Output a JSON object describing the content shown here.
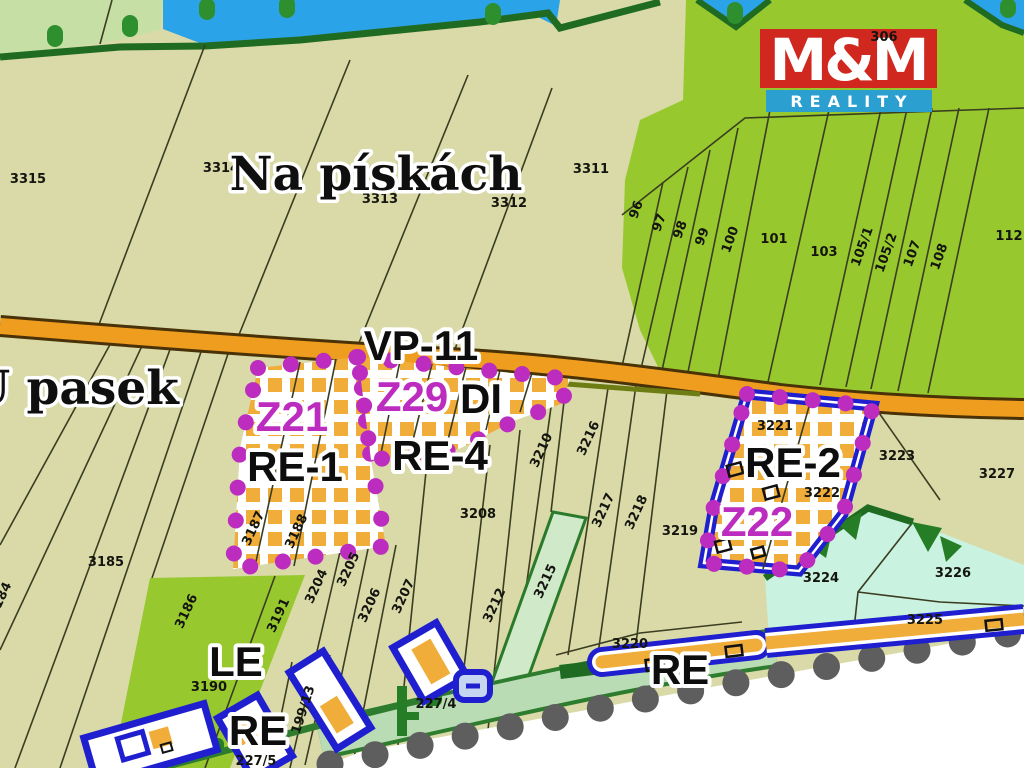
{
  "brand": {
    "name": "M&M",
    "tagline": "REALITY"
  },
  "colors": {
    "parcel_beige": "#d9daa8",
    "field_green": "#97c92f",
    "pale_green": "#c6dfa4",
    "water_blue": "#2ba3e8",
    "mint_green": "#c9f2e0",
    "band_green": "#b9dcb5",
    "forest_green": "#257d25",
    "road_orange": "#ef9d1f",
    "zone_checker_orange": "#f0ad3a",
    "boundary_magenta": "#bc2dbf",
    "zone_blue": "#1f1fd0",
    "dot_gray": "#5e5e5e",
    "logo_red": "#d0281e",
    "logo_blue": "#2a9fd0"
  },
  "places": [
    {
      "text": "Na pískách"
    },
    {
      "text": "U pasek"
    }
  ],
  "zones": [
    {
      "text": "VP-11"
    },
    {
      "text": "Z21"
    },
    {
      "text": "Z29"
    },
    {
      "text": "DI"
    },
    {
      "text": "RE-1"
    },
    {
      "text": "RE-4"
    },
    {
      "text": "RE-2"
    },
    {
      "text": "Z22"
    },
    {
      "text": "LE"
    },
    {
      "text": "RE"
    },
    {
      "text": "RE"
    }
  ],
  "parcels": [
    {
      "text": "3315"
    },
    {
      "text": "3314"
    },
    {
      "text": "3313"
    },
    {
      "text": "3312"
    },
    {
      "text": "3311"
    },
    {
      "text": "306"
    },
    {
      "text": "96"
    },
    {
      "text": "97"
    },
    {
      "text": "98"
    },
    {
      "text": "99"
    },
    {
      "text": "100"
    },
    {
      "text": "101"
    },
    {
      "text": "103"
    },
    {
      "text": "105/1"
    },
    {
      "text": "105/2"
    },
    {
      "text": "107"
    },
    {
      "text": "108"
    },
    {
      "text": "112"
    },
    {
      "text": "3210"
    },
    {
      "text": "3216"
    },
    {
      "text": "3217"
    },
    {
      "text": "3218"
    },
    {
      "text": "3219"
    },
    {
      "text": "3221"
    },
    {
      "text": "3222"
    },
    {
      "text": "3223"
    },
    {
      "text": "3227"
    },
    {
      "text": "3208"
    },
    {
      "text": "3212"
    },
    {
      "text": "3215"
    },
    {
      "text": "3204"
    },
    {
      "text": "3205"
    },
    {
      "text": "3206"
    },
    {
      "text": "3207"
    },
    {
      "text": "3187"
    },
    {
      "text": "3188"
    },
    {
      "text": "3185"
    },
    {
      "text": "3184"
    },
    {
      "text": "3186"
    },
    {
      "text": "3191"
    },
    {
      "text": "3190"
    },
    {
      "text": "3224"
    },
    {
      "text": "3226"
    },
    {
      "text": "3225"
    },
    {
      "text": "3220"
    },
    {
      "text": "199/13"
    },
    {
      "text": "227/4"
    },
    {
      "text": "227/5"
    }
  ]
}
